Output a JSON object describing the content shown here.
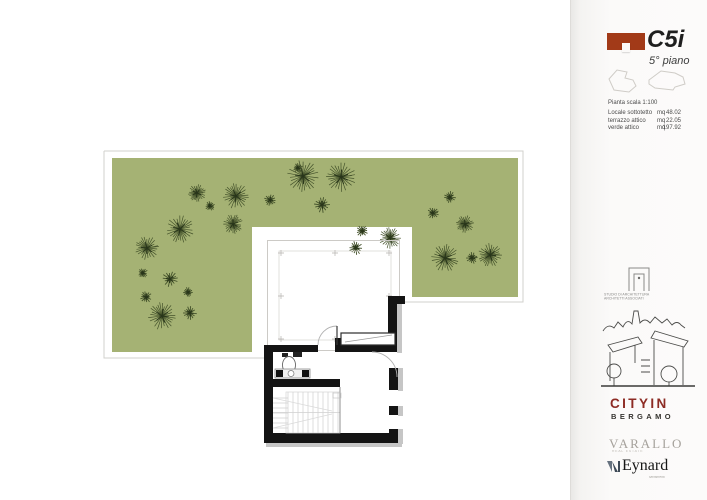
{
  "sidebar": {
    "unit_code": "C5i",
    "floor_label": "5° piano",
    "scale_label": "Pianta scala 1:100",
    "accent_color": "#a23a18",
    "areas": [
      {
        "label": "Locale sottotetto",
        "unit": "mq",
        "value": "48.02"
      },
      {
        "label": "terrazzo attico",
        "unit": "mq",
        "value": "22.05"
      },
      {
        "label": "verde attico",
        "unit": "mq",
        "value": "197.92"
      }
    ],
    "studio_caption_line1": "STUDIO DI ARCHITETTURA",
    "studio_caption_line2": "ARCHITETTI ASSOCIATI",
    "brand": {
      "name": "CITYIN",
      "city": "BERGAMO",
      "color": "#8d2b24"
    },
    "partners": [
      {
        "name": "VARALLO",
        "sub": "REAL ESTATE"
      },
      {
        "name": "Eynard",
        "sub": "serramenti"
      }
    ]
  },
  "plan": {
    "colors": {
      "green": "#a5b274",
      "tree": "#44522b",
      "tree_dark": "#28351a",
      "wall": "#141414",
      "shadow": "#c6c6c6",
      "boundary": "#d2d0cc"
    },
    "green_area_polygon": "112,158 518,158 518,297 412,297 412,227 252,227 252,352 112,352",
    "trees": [
      {
        "x": 197,
        "y": 193,
        "r": 9
      },
      {
        "x": 236,
        "y": 196,
        "r": 13
      },
      {
        "x": 303,
        "y": 176,
        "r": 16
      },
      {
        "x": 341,
        "y": 177,
        "r": 15
      },
      {
        "x": 270,
        "y": 200,
        "r": 6
      },
      {
        "x": 322,
        "y": 205,
        "r": 8
      },
      {
        "x": 210,
        "y": 206,
        "r": 5
      },
      {
        "x": 180,
        "y": 229,
        "r": 14
      },
      {
        "x": 147,
        "y": 248,
        "r": 12
      },
      {
        "x": 233,
        "y": 224,
        "r": 10
      },
      {
        "x": 362,
        "y": 231,
        "r": 6
      },
      {
        "x": 390,
        "y": 238,
        "r": 11
      },
      {
        "x": 356,
        "y": 248,
        "r": 7
      },
      {
        "x": 433,
        "y": 213,
        "r": 6
      },
      {
        "x": 450,
        "y": 197,
        "r": 6
      },
      {
        "x": 465,
        "y": 224,
        "r": 9
      },
      {
        "x": 445,
        "y": 258,
        "r": 14
      },
      {
        "x": 490,
        "y": 255,
        "r": 12
      },
      {
        "x": 472,
        "y": 258,
        "r": 6
      },
      {
        "x": 143,
        "y": 273,
        "r": 5
      },
      {
        "x": 170,
        "y": 279,
        "r": 8
      },
      {
        "x": 188,
        "y": 292,
        "r": 5
      },
      {
        "x": 146,
        "y": 297,
        "r": 6
      },
      {
        "x": 162,
        "y": 316,
        "r": 14
      },
      {
        "x": 190,
        "y": 313,
        "r": 7
      },
      {
        "x": 298,
        "y": 168,
        "r": 5
      }
    ]
  }
}
